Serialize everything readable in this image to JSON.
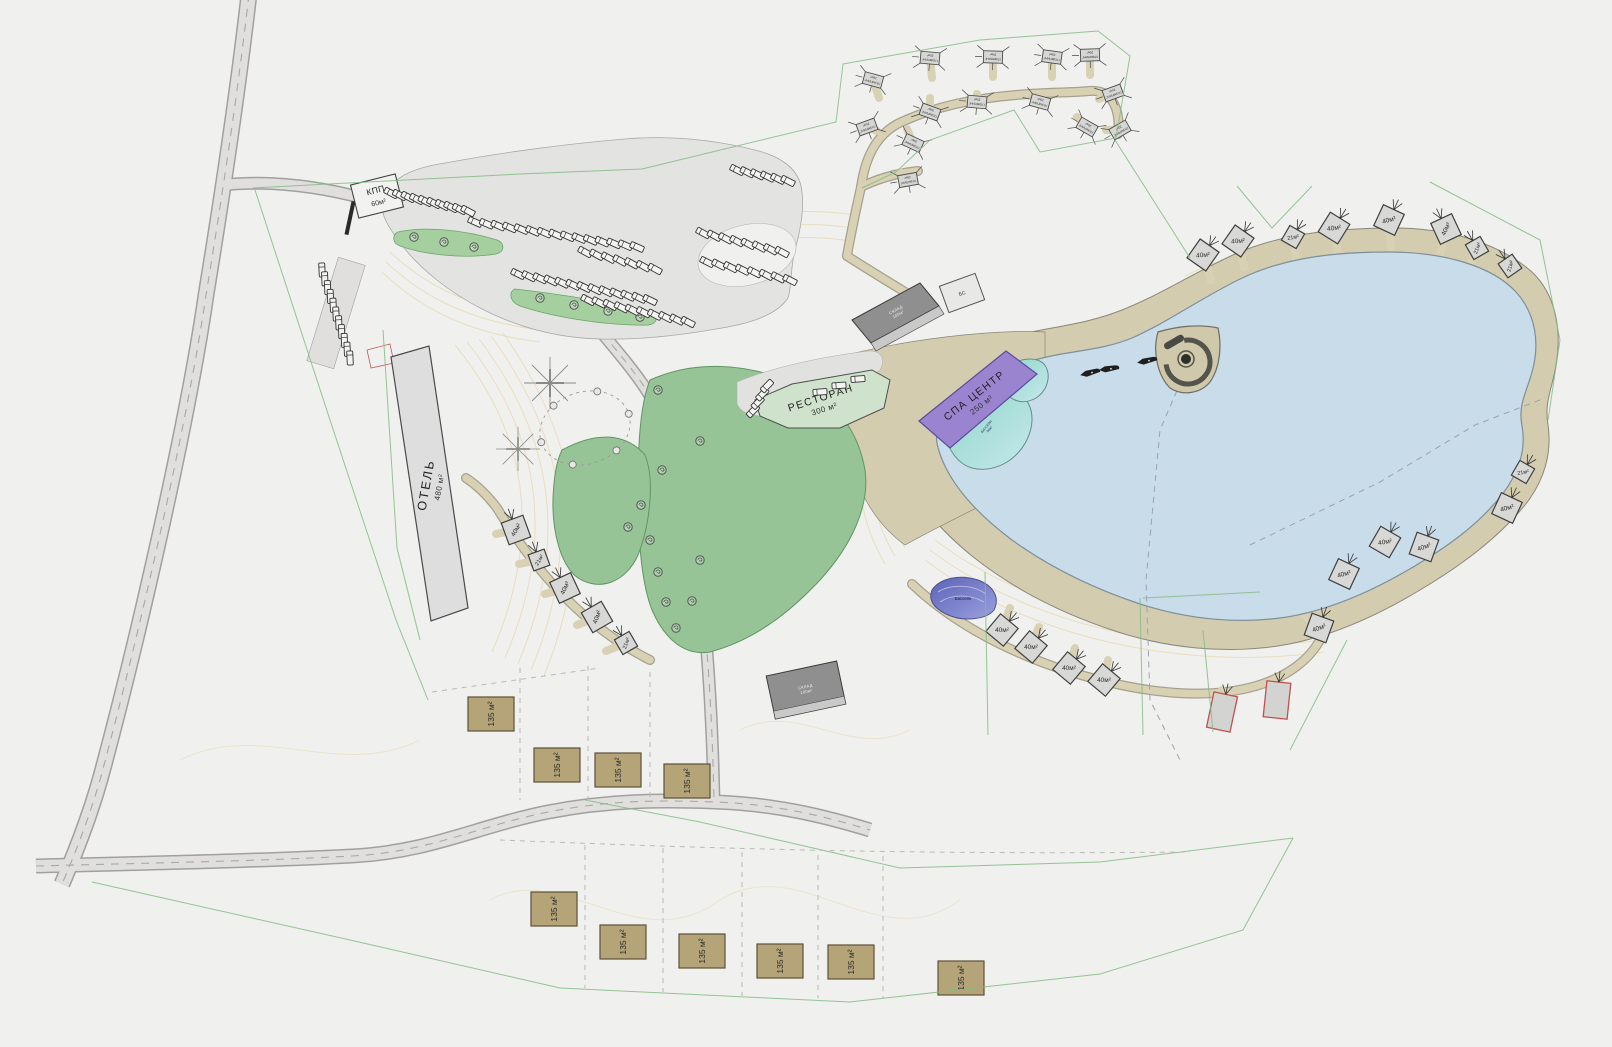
{
  "canvas": {
    "width": 1612,
    "height": 1047
  },
  "colors": {
    "background": "#f0f0ee",
    "road_fill": "#e0dfdd",
    "road_edge": "#9f9f9d",
    "path_tan": "#d6cfb1",
    "path_casing": "#a5a18e",
    "lake": "#c9dce9",
    "lake_edge": "#7e8f9c",
    "green_park": "#97c497",
    "green_island": "#a6cfa0",
    "green_line": "#85bb85",
    "building_gray": "#dedede",
    "building_dark": "#8f8f8f",
    "cabin_gray": "#d8d8d6",
    "cottage_khaki": "#b4a477",
    "spa_purple": "#9b84cf",
    "restaurant_green": "#cfe2cc",
    "pool_teal": "#8fd6c8",
    "pond_blue": "#6f74c9",
    "red_outline": "#c0504d",
    "contour": "#e7ddb8"
  },
  "labels": {
    "kpp": {
      "line1": "КПП",
      "line2": "60м²"
    },
    "hotel": {
      "line1": "ОТЕЛЬ",
      "line2": "480 м²"
    },
    "restaurant": {
      "line1": "РЕСТОРАН",
      "line2": "300 м²"
    },
    "spa": {
      "line1": "СПА ЦЕНТР",
      "line2": "250 м²"
    },
    "pool": {
      "line1": "БАССЕЙН",
      "line2": "50м²"
    },
    "warehouse": {
      "line1": "СКЛАД",
      "line2": "100м²"
    },
    "utility": {
      "line1": "БС"
    },
    "pond": {
      "line1": "Бассейн"
    },
    "tent": {
      "line1": "ГЛЭМПИНГ",
      "line2": "20м²"
    }
  },
  "cabins": {
    "items": [
      {
        "x": 1203,
        "y": 255,
        "r": 35,
        "label": "40м²",
        "sdx": 8,
        "sdy": 26
      },
      {
        "x": 1238,
        "y": 241,
        "r": 35,
        "label": "40м²",
        "sdx": 6,
        "sdy": 26
      },
      {
        "x": 1293,
        "y": 237,
        "r": 30,
        "label": "21м²",
        "sdx": 4,
        "sdy": 26
      },
      {
        "x": 1334,
        "y": 228,
        "r": 32,
        "label": "40м²",
        "sdx": 4,
        "sdy": 26
      },
      {
        "x": 1389,
        "y": 220,
        "r": 25,
        "label": "40м²",
        "sdx": 2,
        "sdy": 28
      },
      {
        "x": 1446,
        "y": 229,
        "r": -25,
        "label": "40м²",
        "sdx": -6,
        "sdy": 26
      },
      {
        "x": 1477,
        "y": 248,
        "r": -30,
        "label": "21м²",
        "sdx": -10,
        "sdy": 24
      },
      {
        "x": 1510,
        "y": 266,
        "r": -35,
        "label": "21м²",
        "sdx": -12,
        "sdy": 22
      },
      {
        "x": 1523,
        "y": 472,
        "r": 30,
        "label": "21м²",
        "sdx": -8,
        "sdy": -24
      },
      {
        "x": 1507,
        "y": 508,
        "r": 25,
        "label": "40м²",
        "sdx": -22,
        "sdy": -12
      },
      {
        "x": 1424,
        "y": 547,
        "r": 20,
        "label": "40м²",
        "sdx": -6,
        "sdy": -24
      },
      {
        "x": 1385,
        "y": 542,
        "r": 30,
        "label": "40м²",
        "sdx": -6,
        "sdy": -24
      },
      {
        "x": 1344,
        "y": 574,
        "r": 25,
        "label": "40м²",
        "sdx": -20,
        "sdy": -14
      },
      {
        "x": 1319,
        "y": 628,
        "r": 20,
        "label": "40м²",
        "sdx": -18,
        "sdy": -16
      },
      {
        "x": 1002,
        "y": 630,
        "r": 40,
        "label": "40м²",
        "sdx": 8,
        "sdy": -22
      },
      {
        "x": 1031,
        "y": 647,
        "r": 40,
        "label": "40м²",
        "sdx": 8,
        "sdy": -20
      },
      {
        "x": 1069,
        "y": 668,
        "r": 40,
        "label": "40м²",
        "sdx": 6,
        "sdy": -20
      },
      {
        "x": 1104,
        "y": 680,
        "r": 40,
        "label": "40м²",
        "sdx": 4,
        "sdy": -20
      },
      {
        "x": 516,
        "y": 530,
        "r": -20,
        "label": "40м²",
        "sdx": -20,
        "sdy": 4
      },
      {
        "x": 539,
        "y": 560,
        "r": -20,
        "label": "21м²",
        "sdx": -20,
        "sdy": 4
      },
      {
        "x": 565,
        "y": 588,
        "r": -25,
        "label": "40м²",
        "sdx": -20,
        "sdy": 6
      },
      {
        "x": 597,
        "y": 617,
        "r": -30,
        "label": "40м²",
        "sdx": -20,
        "sdy": 8
      },
      {
        "x": 626,
        "y": 643,
        "r": -30,
        "label": "21м²",
        "sdx": -20,
        "sdy": 8
      }
    ]
  },
  "red_cabins": {
    "items": [
      {
        "x": 1222,
        "y": 712,
        "r": 12
      },
      {
        "x": 1277,
        "y": 700,
        "r": 6
      }
    ]
  },
  "tents": {
    "items": [
      {
        "x": 873,
        "y": 80,
        "r": 195,
        "sdx": 6,
        "sdy": 18
      },
      {
        "x": 930,
        "y": 58,
        "r": 185,
        "sdx": 2,
        "sdy": 20
      },
      {
        "x": 993,
        "y": 57,
        "r": 182,
        "sdx": 0,
        "sdy": 20
      },
      {
        "x": 1052,
        "y": 57,
        "r": 188,
        "sdx": 0,
        "sdy": 20
      },
      {
        "x": 1090,
        "y": 55,
        "r": 178,
        "sdx": 0,
        "sdy": 20
      },
      {
        "x": 1113,
        "y": 93,
        "r": 160,
        "sdx": -14,
        "sdy": 6
      },
      {
        "x": 1120,
        "y": 130,
        "r": 150,
        "sdx": -14,
        "sdy": 0
      },
      {
        "x": 1087,
        "y": 127,
        "r": 210,
        "sdx": -10,
        "sdy": -10
      },
      {
        "x": 1040,
        "y": 102,
        "r": 195,
        "sdx": 0,
        "sdy": -8
      },
      {
        "x": 977,
        "y": 102,
        "r": 185,
        "sdx": 0,
        "sdy": -8
      },
      {
        "x": 930,
        "y": 112,
        "r": 200,
        "sdx": 0,
        "sdy": -14
      },
      {
        "x": 867,
        "y": 127,
        "r": 160,
        "sdx": 10,
        "sdy": 4
      },
      {
        "x": 913,
        "y": 143,
        "r": 205,
        "sdx": -6,
        "sdy": -14
      },
      {
        "x": 908,
        "y": 180,
        "r": 170,
        "sdx": -8,
        "sdy": -8
      }
    ]
  },
  "cottages": {
    "label": "135 м²",
    "items": [
      {
        "x": 491,
        "y": 714
      },
      {
        "x": 557,
        "y": 765
      },
      {
        "x": 618,
        "y": 770
      },
      {
        "x": 687,
        "y": 781
      },
      {
        "x": 554,
        "y": 909
      },
      {
        "x": 623,
        "y": 942
      },
      {
        "x": 702,
        "y": 951
      },
      {
        "x": 780,
        "y": 961
      },
      {
        "x": 851,
        "y": 962
      },
      {
        "x": 961,
        "y": 978
      }
    ]
  },
  "parking_rows": {
    "items": [
      {
        "x1": 391,
        "y1": 193,
        "x2": 468,
        "y2": 211,
        "n": 10
      },
      {
        "x1": 475,
        "y1": 222,
        "x2": 637,
        "y2": 247,
        "n": 15
      },
      {
        "x1": 518,
        "y1": 274,
        "x2": 650,
        "y2": 300,
        "n": 13
      },
      {
        "x1": 585,
        "y1": 252,
        "x2": 655,
        "y2": 269,
        "n": 7
      },
      {
        "x1": 588,
        "y1": 300,
        "x2": 688,
        "y2": 322,
        "n": 10
      },
      {
        "x1": 703,
        "y1": 233,
        "x2": 782,
        "y2": 252,
        "n": 8
      },
      {
        "x1": 707,
        "y1": 262,
        "x2": 790,
        "y2": 280,
        "n": 8
      },
      {
        "x1": 737,
        "y1": 170,
        "x2": 788,
        "y2": 181,
        "n": 6
      },
      {
        "x1": 322,
        "y1": 270,
        "x2": 350,
        "y2": 358,
        "n": 11
      },
      {
        "x1": 753,
        "y1": 411,
        "x2": 767,
        "y2": 386,
        "n": 4
      },
      {
        "x1": 820,
        "y1": 392,
        "x2": 858,
        "y2": 379,
        "n": 3
      }
    ]
  },
  "boats": {
    "items": [
      {
        "x": 1090,
        "y": 373,
        "r": -12
      },
      {
        "x": 1109,
        "y": 369,
        "r": -6
      },
      {
        "x": 1147,
        "y": 361,
        "r": -10
      }
    ]
  },
  "trees": {
    "items": [
      {
        "x": 414,
        "y": 237
      },
      {
        "x": 444,
        "y": 242
      },
      {
        "x": 474,
        "y": 247
      },
      {
        "x": 540,
        "y": 298
      },
      {
        "x": 574,
        "y": 305
      },
      {
        "x": 608,
        "y": 311
      },
      {
        "x": 640,
        "y": 317
      },
      {
        "x": 658,
        "y": 390
      },
      {
        "x": 700,
        "y": 441
      },
      {
        "x": 662,
        "y": 470
      },
      {
        "x": 628,
        "y": 527
      },
      {
        "x": 641,
        "y": 505
      },
      {
        "x": 650,
        "y": 540
      },
      {
        "x": 658,
        "y": 572
      },
      {
        "x": 666,
        "y": 602
      },
      {
        "x": 676,
        "y": 628
      },
      {
        "x": 700,
        "y": 560
      },
      {
        "x": 692,
        "y": 601
      }
    ]
  }
}
